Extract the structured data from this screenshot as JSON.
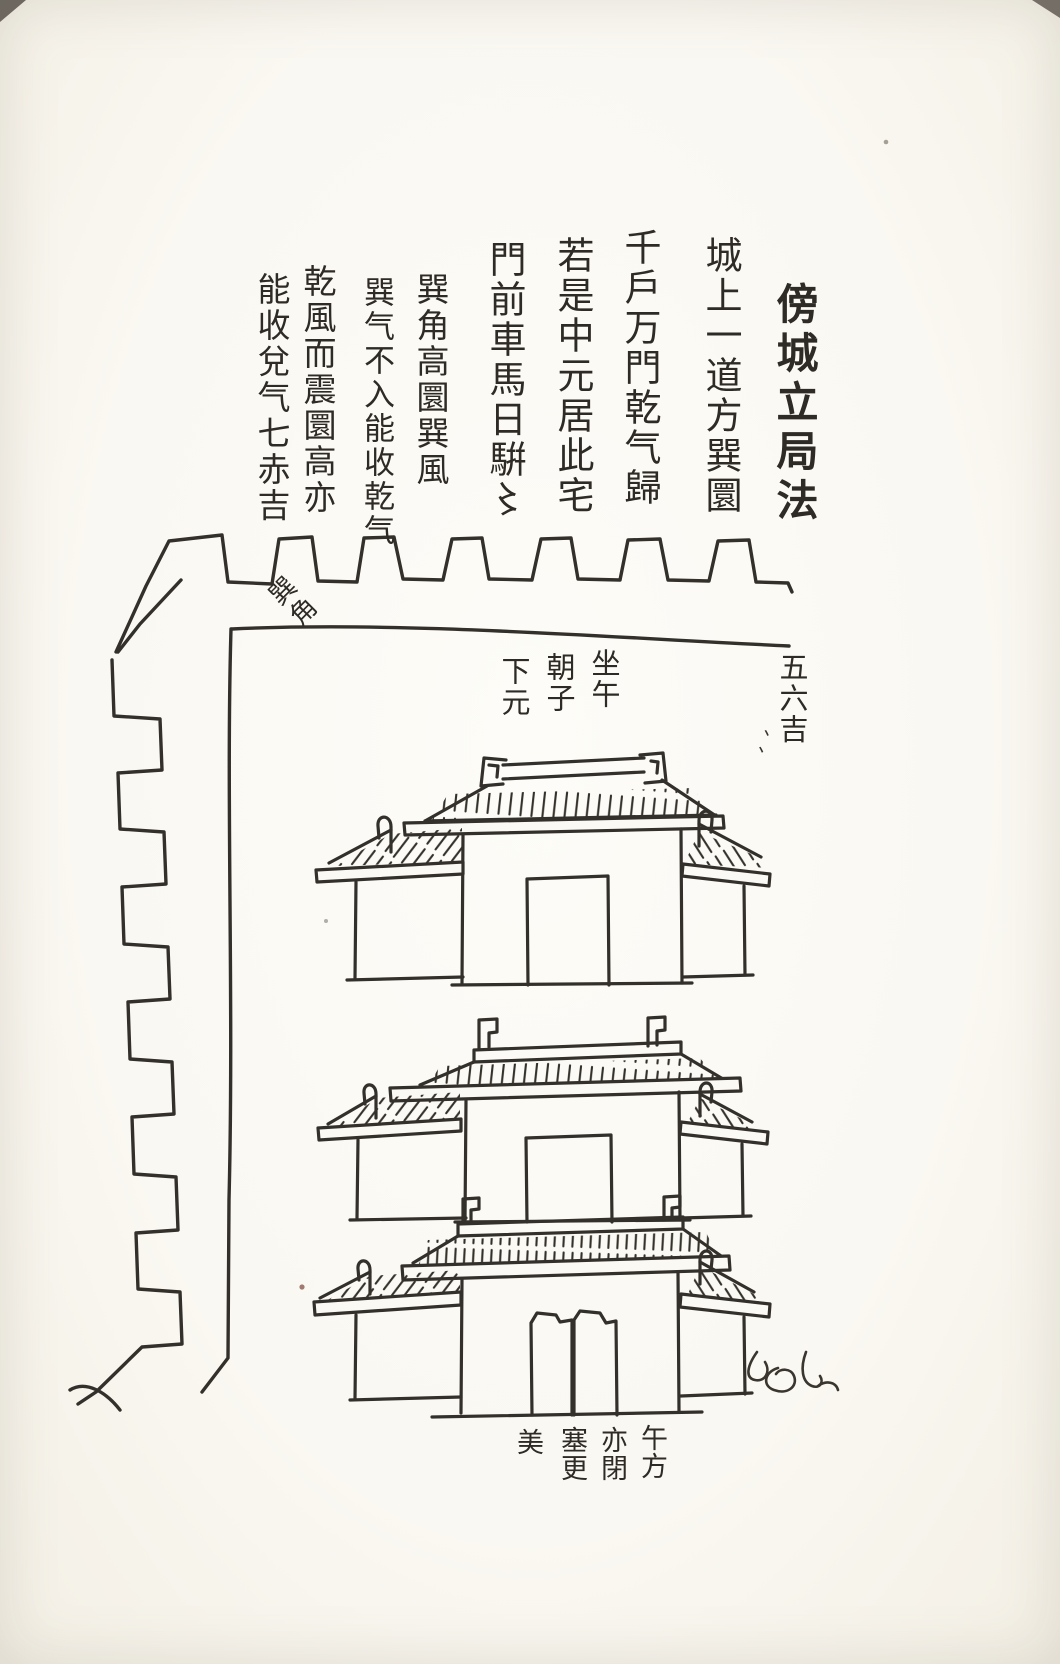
{
  "page": {
    "title": "傍城立局法",
    "paper_color": "#fbf9f4",
    "ink_color": "#33302b"
  },
  "text_columns": [
    {
      "id": "title",
      "text": "傍城立局法"
    },
    {
      "id": "line1",
      "text": "城上一道方巽圜"
    },
    {
      "id": "line2",
      "text": "千戶万門乾气歸"
    },
    {
      "id": "line3",
      "text": "若是中元居此宅"
    },
    {
      "id": "line4",
      "text": "門前車馬日騈〻"
    },
    {
      "id": "line5",
      "text": "巽角高圜巽風"
    },
    {
      "id": "line6",
      "text": "巽气不入能收乾气"
    },
    {
      "id": "line7",
      "text": "乾風而震圜高亦"
    },
    {
      "id": "line8",
      "text": "能收兌气七赤吉"
    }
  ],
  "labels": {
    "corner_label": "巽角",
    "orientation": [
      {
        "text": "坐午"
      },
      {
        "text": "朝子"
      },
      {
        "text": "下元"
      }
    ],
    "right_note": "五六吉",
    "right_note_marks": "、、",
    "bottom_note": [
      {
        "text": "午方"
      },
      {
        "text": "亦閉"
      },
      {
        "text": "塞更"
      },
      {
        "text": "美"
      }
    ]
  },
  "figure": {
    "parts": [
      "city-wall-top-battlements",
      "city-wall-left-battlements",
      "gate-tower-top",
      "gate-tower-middle",
      "gate-tower-bottom",
      "cursive-mark"
    ]
  }
}
